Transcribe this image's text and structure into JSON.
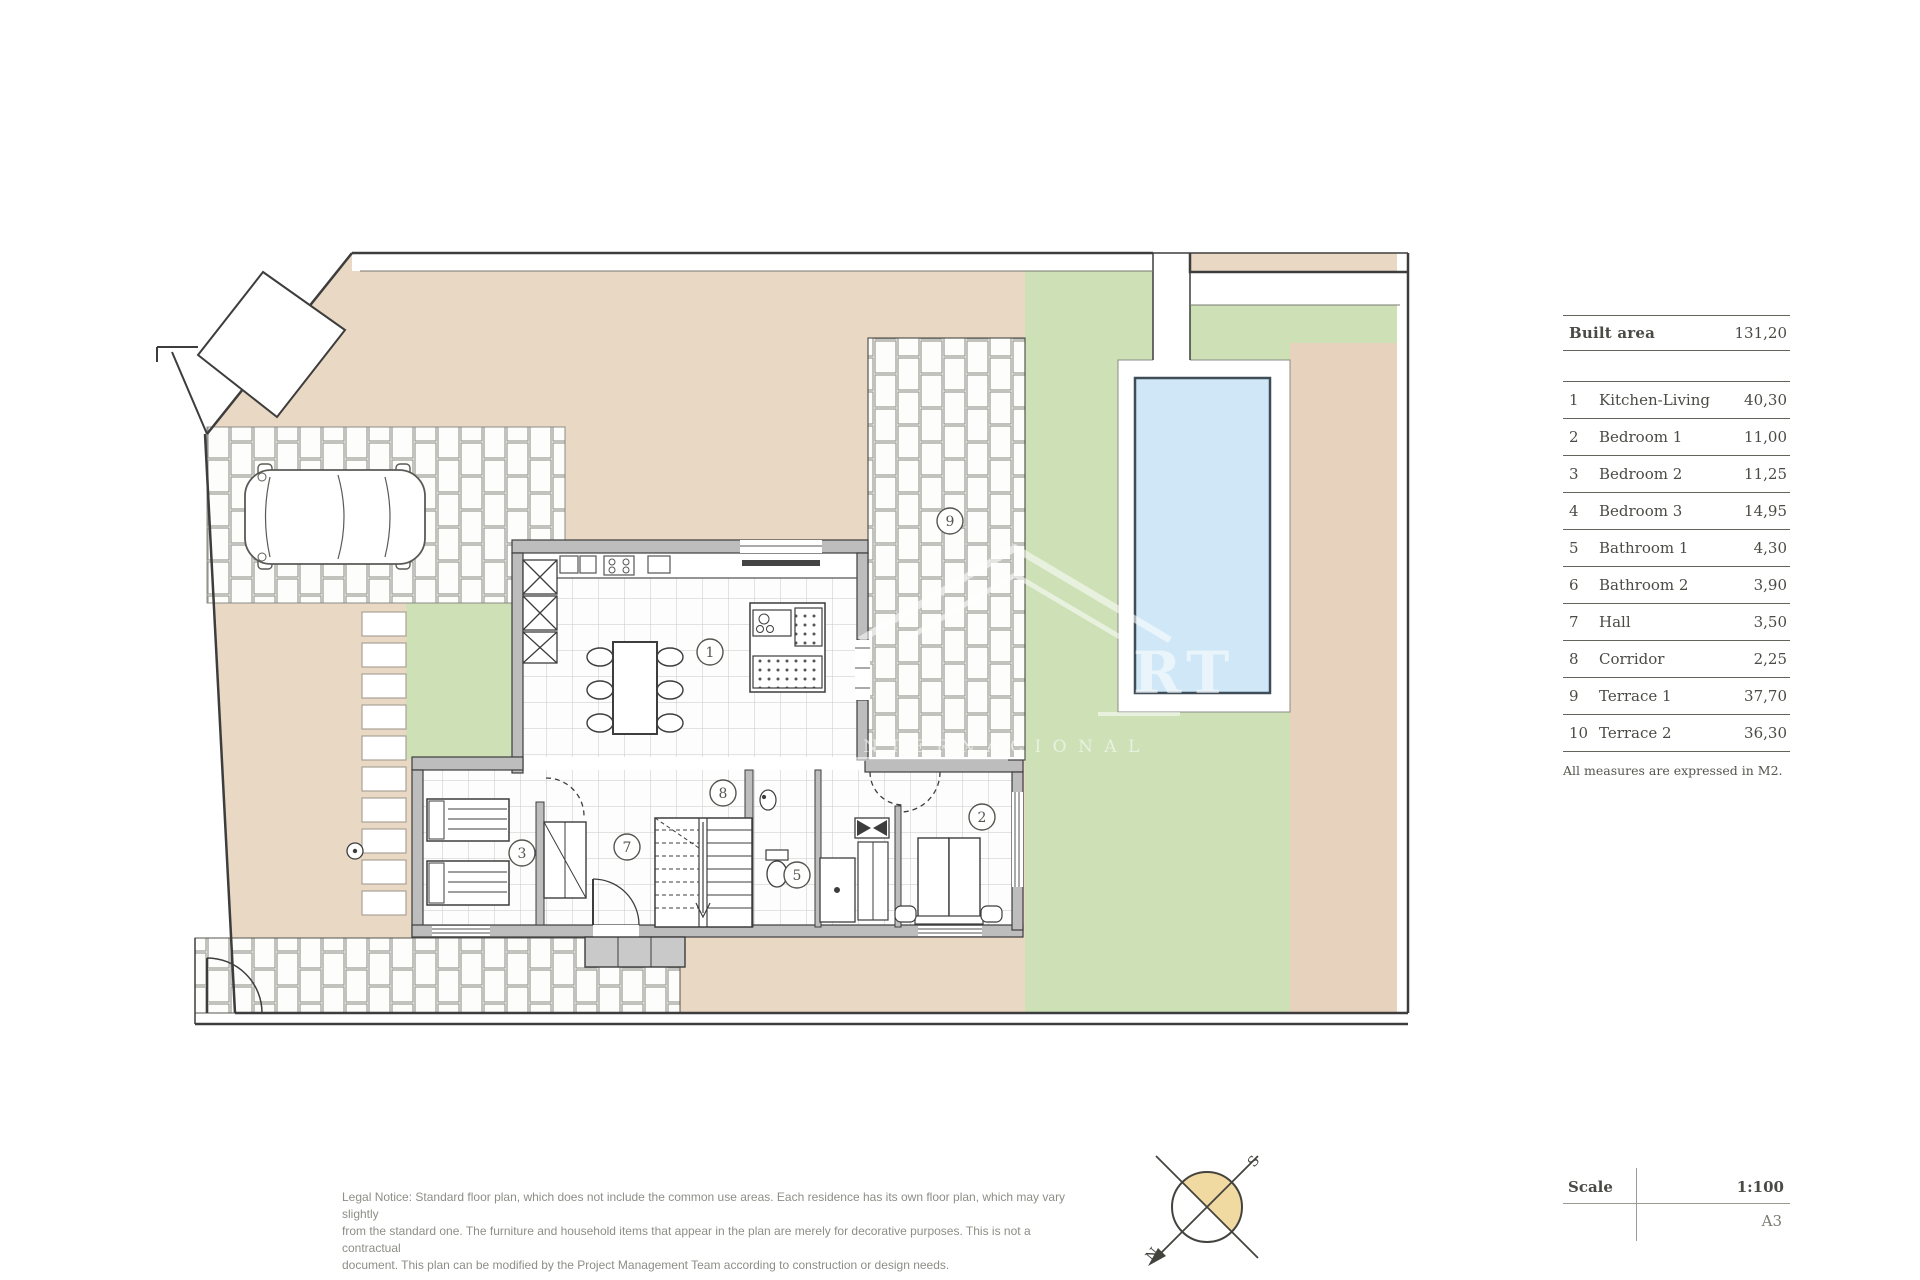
{
  "panel": {
    "built_area_label": "Built area",
    "built_area_value": "131,20",
    "rooms": [
      {
        "num": "1",
        "name": "Kitchen-Living",
        "value": "40,30"
      },
      {
        "num": "2",
        "name": "Bedroom 1",
        "value": "11,00"
      },
      {
        "num": "3",
        "name": "Bedroom 2",
        "value": "11,25"
      },
      {
        "num": "4",
        "name": "Bedroom 3",
        "value": "14,95"
      },
      {
        "num": "5",
        "name": "Bathroom 1",
        "value": "4,30"
      },
      {
        "num": "6",
        "name": "Bathroom 2",
        "value": "3,90"
      },
      {
        "num": "7",
        "name": "Hall",
        "value": "3,50"
      },
      {
        "num": "8",
        "name": "Corridor",
        "value": "2,25"
      },
      {
        "num": "9",
        "name": "Terrace 1",
        "value": "37,70"
      },
      {
        "num": "10",
        "name": "Terrace 2",
        "value": "36,30"
      }
    ],
    "note": "All measures are expressed in M2."
  },
  "titleblock": {
    "scale_label": "Scale",
    "scale_value": "1:100",
    "sheet": "A3"
  },
  "legal": {
    "line1": "Legal Notice: Standard floor plan, which does not include the common use areas. Each residence has its own floor plan, which may vary slightly",
    "line2": "from the standard one. The furniture and household items that appear in the plan are merely for decorative purposes. This is not a contractual",
    "line3": "document. This plan can be modified by the Project Management Team according to construction or design needs."
  },
  "compass": {
    "north": "N",
    "south": "S"
  },
  "plan_labels": {
    "kitchen_living": "1",
    "bedroom1": "2",
    "bedroom2": "3",
    "bathroom1": "5",
    "hall": "7",
    "corridor": "8",
    "terrace1": "9"
  },
  "watermark": {
    "letters": "RT",
    "subtitle": "I N T E R N A C I O N A L"
  },
  "colors": {
    "ground": "#e9d8c3",
    "lawn": "#cde0b6",
    "pool": "#cfe7f7",
    "line": "#3d3d3d"
  }
}
